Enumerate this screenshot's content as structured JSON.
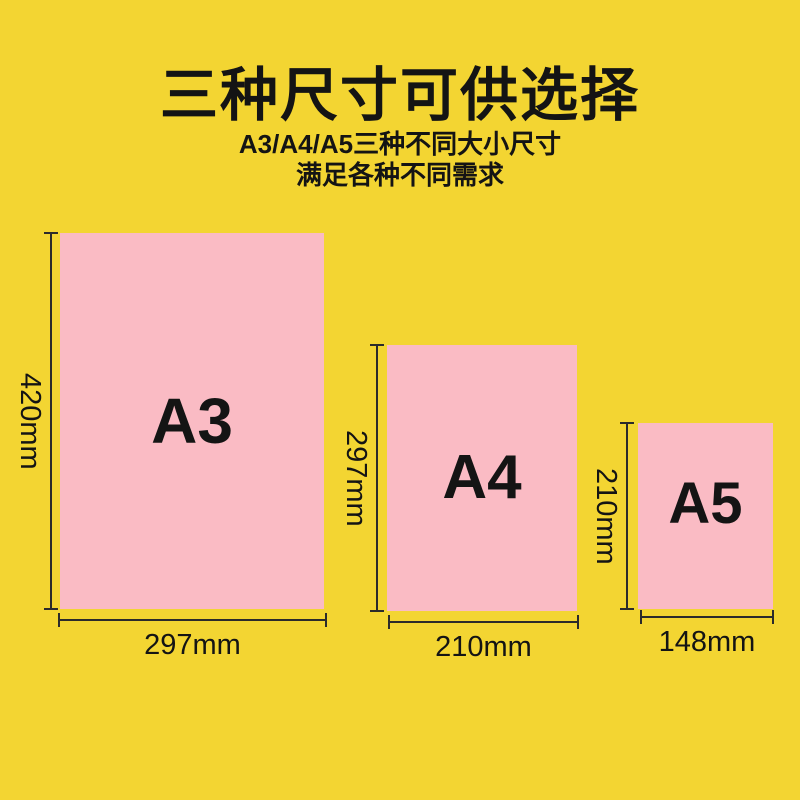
{
  "header": {
    "title": "三种尺寸可供选择",
    "subtitle_line1": "A3/A4/A5三种不同大小尺寸",
    "subtitle_line2": "满足各种不同需求"
  },
  "papers": [
    {
      "name": "A3",
      "width_label": "297mm",
      "height_label": "420mm"
    },
    {
      "name": "A4",
      "width_label": "210mm",
      "height_label": "297mm"
    },
    {
      "name": "A5",
      "width_label": "148mm",
      "height_label": "210mm"
    }
  ],
  "colors": {
    "background": "#F3D532",
    "paper": "#FABBC4",
    "text": "#141414",
    "dimension_line": "#2B2B2B"
  }
}
